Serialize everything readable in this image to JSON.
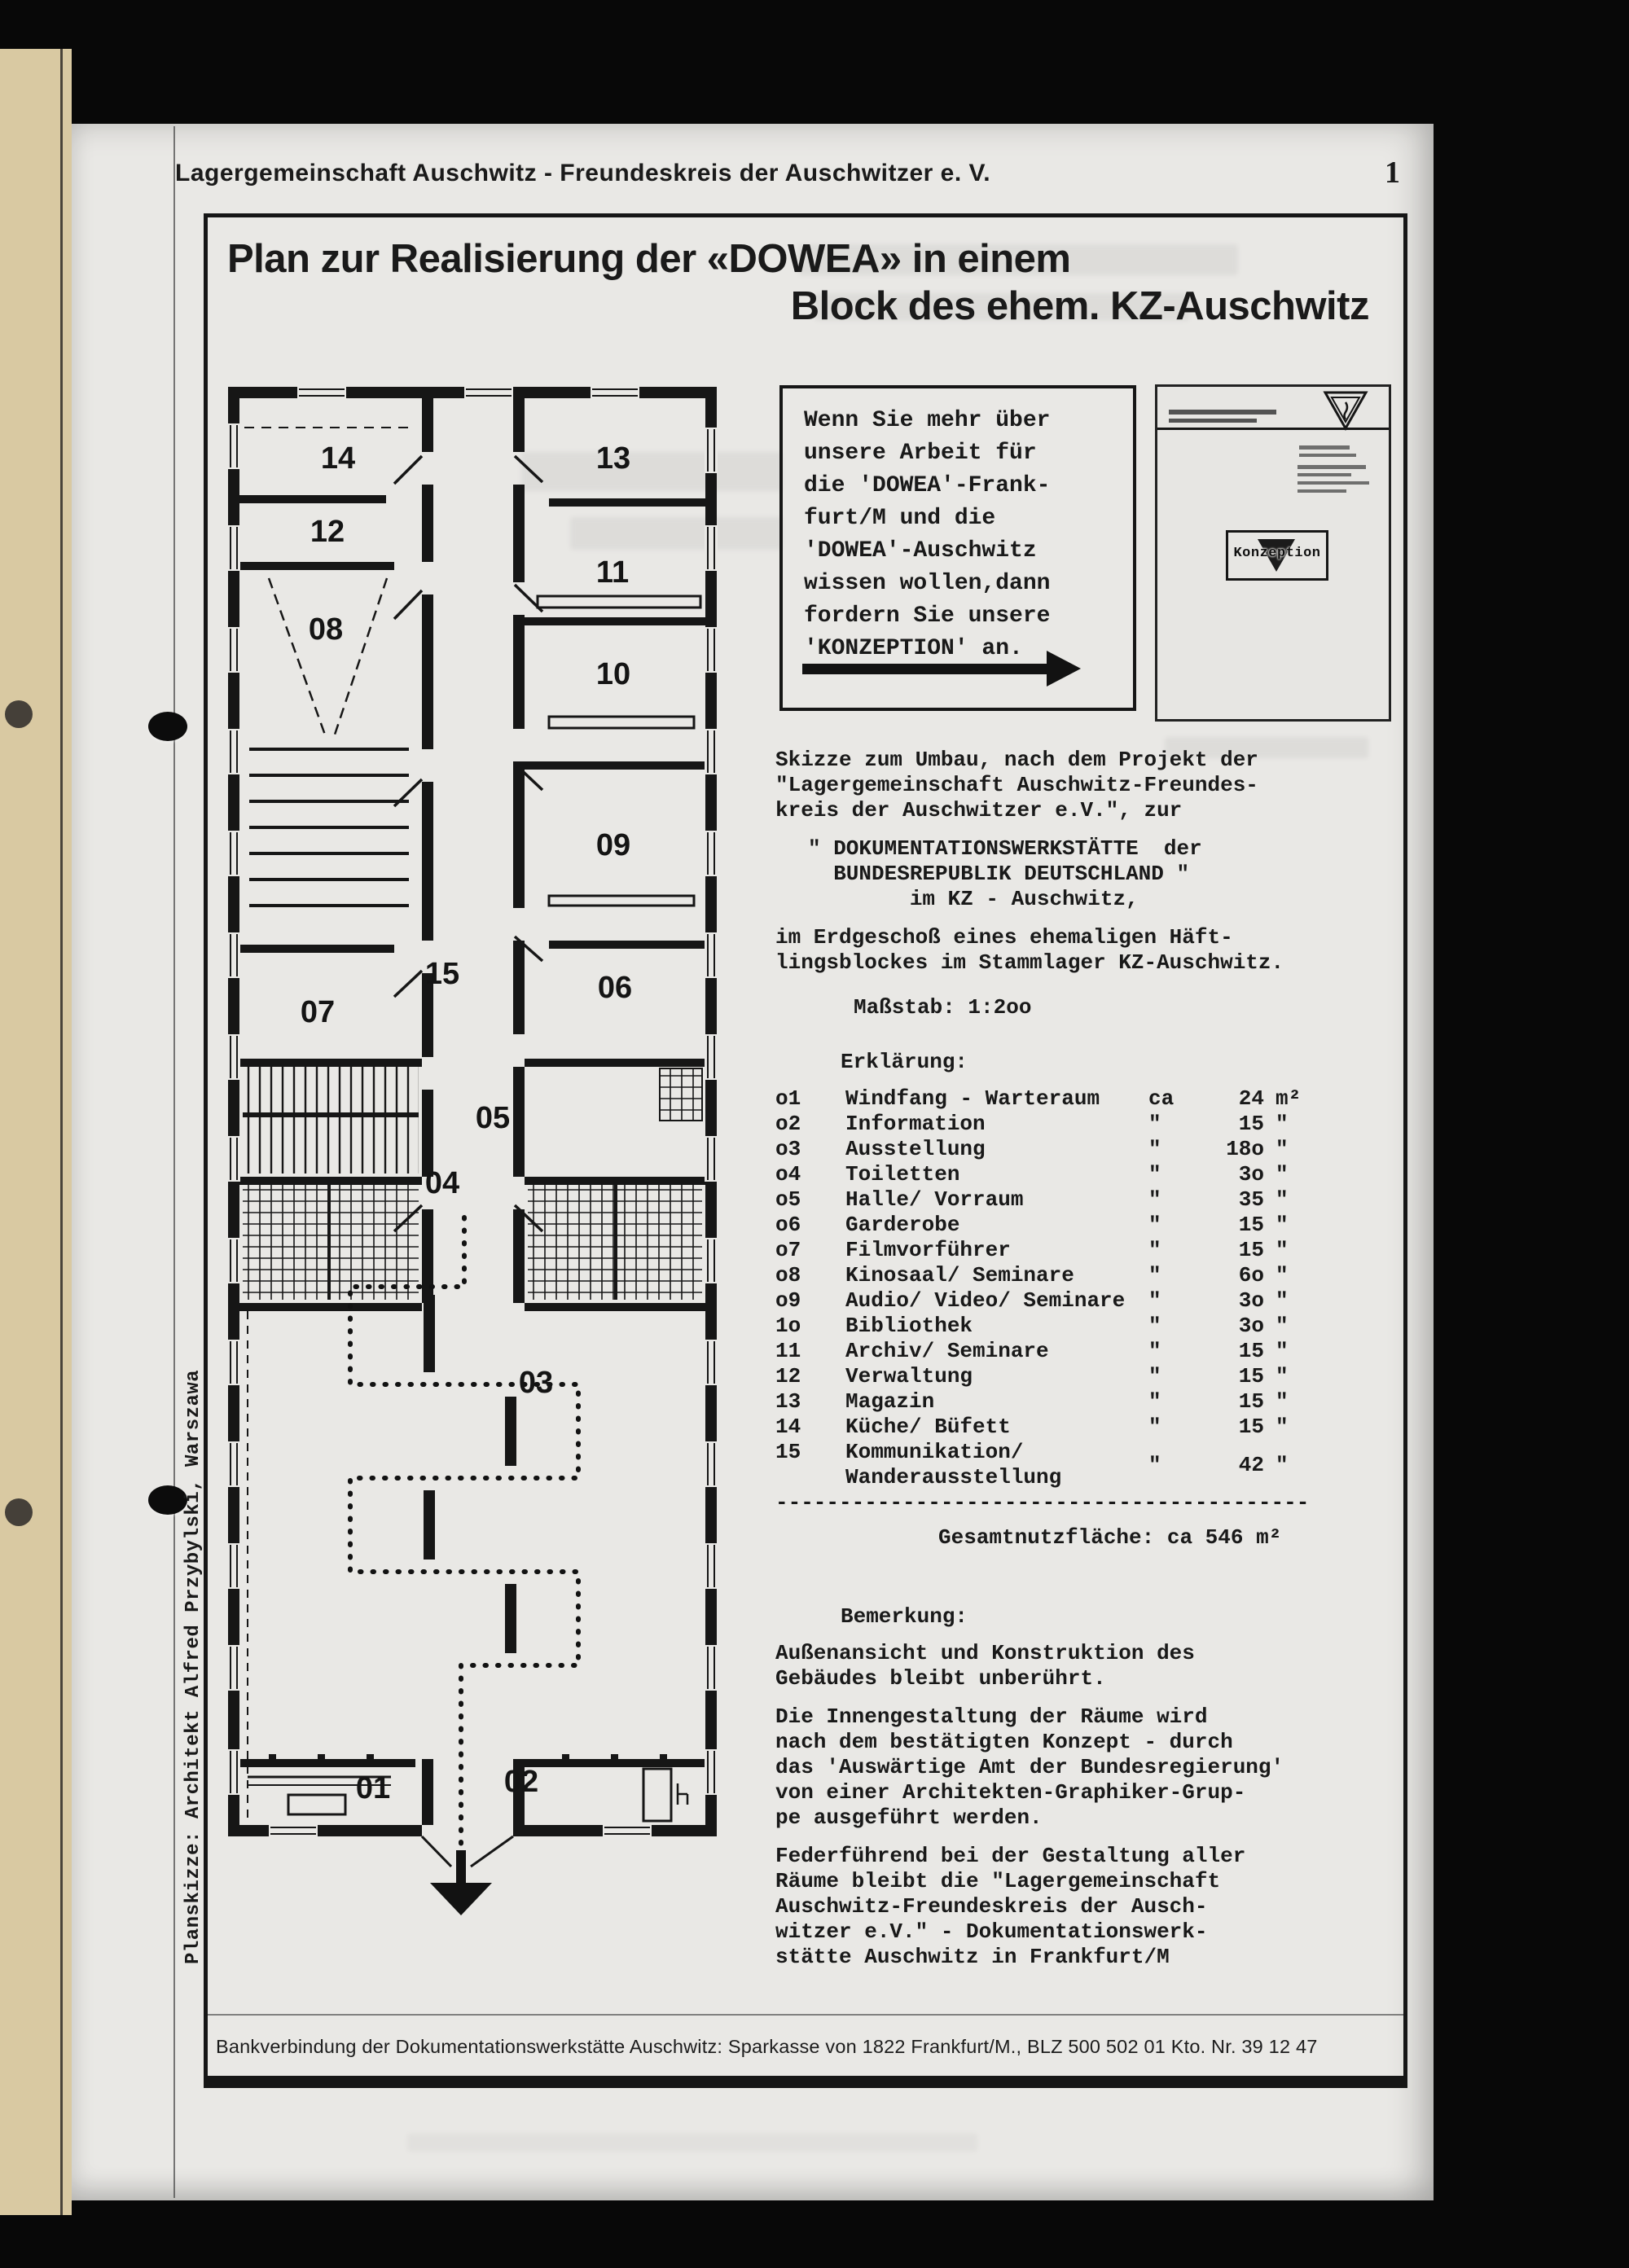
{
  "page": {
    "header": "Lagergemeinschaft Auschwitz - Freundeskreis der Auschwitzer e. V.",
    "page_number": "1",
    "title_line1": "Plan zur Realisierung der «DOWEA» in einem",
    "title_line2": "Block des ehem. KZ-Auschwitz",
    "footer": "Bankverbindung der Dokumentationswerkstätte Auschwitz: Sparkasse von 1822 Frankfurt/M., BLZ 500 502 01 Kto. Nr. 39 12 47"
  },
  "promo": {
    "text": "Wenn Sie mehr über\nunsere Arbeit für\ndie 'DOWEA'-Frank-\nfurt/M  und die\n'DOWEA'-Auschwitz\nwissen wollen,dann\nfordern Sie unsere\n'KONZEPTION' an."
  },
  "brochure": {
    "badge": "Konzeption"
  },
  "sketch": {
    "para1": "Skizze zum Umbau, nach dem Projekt der\n\"Lagergemeinschaft Auschwitz-Freundes-\nkreis der Auschwitzer e.V.\", zur",
    "block": "\" DOKUMENTATIONSWERKSTÄTTE  der\n  BUNDESREPUBLIK DEUTSCHLAND \"\n        im KZ - Auschwitz,",
    "para2": "im Erdgeschoß eines ehemaligen Häft-\nlingsblockes im Stammlager KZ-Auschwitz.",
    "scale_note": "Maßstab: 1:2oo"
  },
  "legend": {
    "heading": "Erklärung:",
    "rows": [
      {
        "no": "o1",
        "name": "Windfang - Warteraum",
        "approx": "ca",
        "value": "24",
        "unit": "m²"
      },
      {
        "no": "o2",
        "name": "Information",
        "approx": "\"",
        "value": "15",
        "unit": "\""
      },
      {
        "no": "o3",
        "name": "Ausstellung",
        "approx": "\"",
        "value": "18o",
        "unit": "\""
      },
      {
        "no": "o4",
        "name": "Toiletten",
        "approx": "\"",
        "value": "3o",
        "unit": "\""
      },
      {
        "no": "o5",
        "name": "Halle/ Vorraum",
        "approx": "\"",
        "value": "35",
        "unit": "\""
      },
      {
        "no": "o6",
        "name": "Garderobe",
        "approx": "\"",
        "value": "15",
        "unit": "\""
      },
      {
        "no": "o7",
        "name": "Filmvorführer",
        "approx": "\"",
        "value": "15",
        "unit": "\""
      },
      {
        "no": "o8",
        "name": "Kinosaal/ Seminare",
        "approx": "\"",
        "value": "6o",
        "unit": "\""
      },
      {
        "no": "o9",
        "name": "Audio/ Video/ Seminare",
        "approx": "\"",
        "value": "3o",
        "unit": "\""
      },
      {
        "no": "1o",
        "name": "Bibliothek",
        "approx": "\"",
        "value": "3o",
        "unit": "\""
      },
      {
        "no": "11",
        "name": "Archiv/ Seminare",
        "approx": "\"",
        "value": "15",
        "unit": "\""
      },
      {
        "no": "12",
        "name": "Verwaltung",
        "approx": "\"",
        "value": "15",
        "unit": "\""
      },
      {
        "no": "13",
        "name": "Magazin",
        "approx": "\"",
        "value": "15",
        "unit": "\""
      },
      {
        "no": "14",
        "name": "Küche/ Büfett",
        "approx": "\"",
        "value": "15",
        "unit": "\""
      },
      {
        "no": "15",
        "name": "Kommunikation/\nWanderausstellung",
        "approx": "\"",
        "value": "42",
        "unit": "\""
      }
    ],
    "separator": "------------------------------------------",
    "total": "Gesamtnutzfläche: ca 546 m²"
  },
  "remark": {
    "heading": "Bemerkung:",
    "para1": "Außenansicht und Konstruktion des\nGebäudes bleibt unberührt.",
    "para2": "Die Innengestaltung der Räume wird\nnach dem bestätigten Konzept - durch\ndas 'Auswärtige Amt der Bundesregierung'\nvon einer Architekten-Graphiker-Grup-\npe ausgeführt werden.",
    "para3": "Federführend bei der Gestaltung aller\nRäume bleibt die \"Lagergemeinschaft\nAuschwitz-Freundeskreis der Ausch-\nwitzer e.V.\" - Dokumentationswerk-\nstätte Auschwitz in Frankfurt/M"
  },
  "floorplan": {
    "credit": "Planskizze: Architekt Alfred Przybylski, Warszawa",
    "rooms": [
      "14",
      "13",
      "12",
      "11",
      "08",
      "10",
      "09",
      "07",
      "15",
      "06",
      "05",
      "04",
      "03",
      "01",
      "02"
    ]
  },
  "colors": {
    "page": "#e9e8e5",
    "ink": "#1a1a1a",
    "backdrop": "#080808",
    "cream": "#d9c9a2"
  }
}
